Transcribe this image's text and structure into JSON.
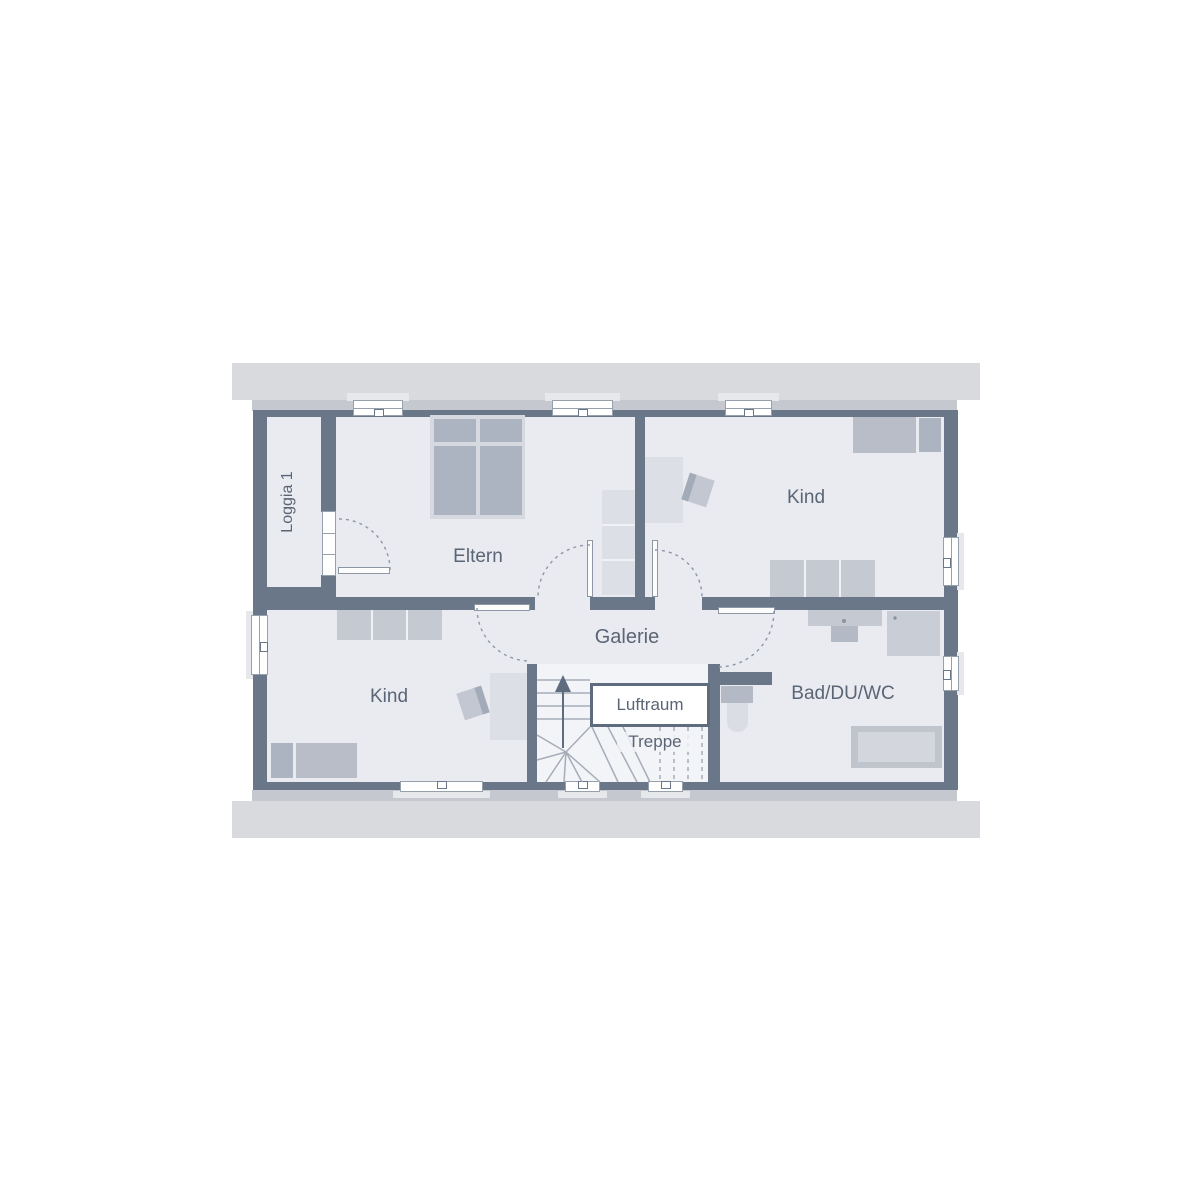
{
  "rooms": {
    "loggia": {
      "label": "Loggia 1"
    },
    "eltern": {
      "label": "Eltern"
    },
    "kind_top": {
      "label": "Kind"
    },
    "kind_bottom": {
      "label": "Kind"
    },
    "galerie": {
      "label": "Galerie"
    },
    "luftraum": {
      "label": "Luftraum"
    },
    "treppe": {
      "label": "Treppe"
    },
    "bad": {
      "label": "Bad/DU/WC"
    }
  },
  "colors": {
    "wall": "#6a7789",
    "floor": "#e9ebf0",
    "stair_floor": "#f3f4f7",
    "roof_band": "#d8dade",
    "eaves_strip": "#c5c8cf",
    "furniture_light": "#dcdfe6",
    "furniture_medium": "#c4c9d2",
    "furniture_dark": "#adb4c1",
    "mattress": "#b8bdc8",
    "label_text": "#5a6575",
    "swing_arc": "#8e97a5"
  }
}
